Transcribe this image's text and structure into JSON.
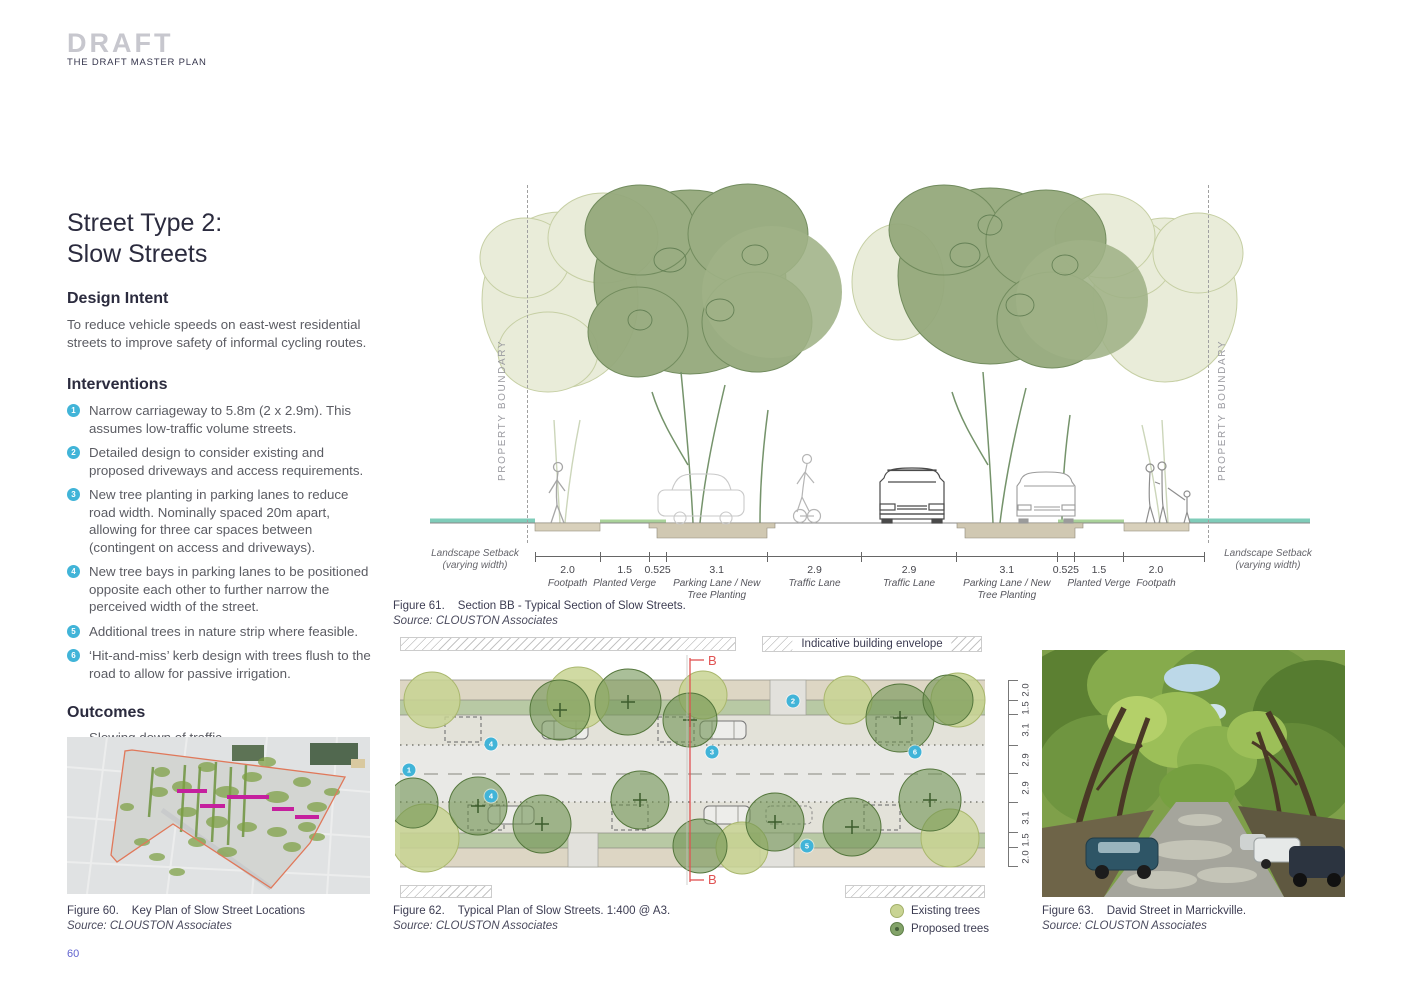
{
  "header": {
    "title": "DRAFT",
    "subtitle": "THE DRAFT MASTER PLAN"
  },
  "page": {
    "number": "60"
  },
  "content": {
    "title_line1": "Street Type 2:",
    "title_line2": "Slow Streets",
    "design_intent": {
      "heading": "Design Intent",
      "body": "To reduce vehicle speeds on east-west residential streets to improve safety of informal cycling routes."
    },
    "interventions": {
      "heading": "Interventions",
      "items": [
        {
          "num": "1",
          "text": "Narrow carriageway to 5.8m (2 x 2.9m). This assumes low-traffic volume streets."
        },
        {
          "num": "2",
          "text": "Detailed design to consider existing and proposed driveways and access requirements."
        },
        {
          "num": "3",
          "text": "New tree planting in parking lanes to reduce road width. Nominally spaced 20m apart, allowing for three car spaces between (contingent on access and driveways)."
        },
        {
          "num": "4",
          "text": "New tree bays in parking lanes to be positioned opposite each other to further narrow the perceived width of the street."
        },
        {
          "num": "5",
          "text": "Additional trees in nature strip where feasible."
        },
        {
          "num": "6",
          "text": "‘Hit-and-miss’ kerb design with trees flush to the road to allow for passive irrigation."
        }
      ]
    },
    "outcomes": {
      "heading": "Outcomes",
      "items": [
        "Slowing down of traffic.",
        "Increase of canopy coverage."
      ]
    }
  },
  "figures": {
    "key_plan": {
      "label": "Figure 60.",
      "title": "Key Plan of Slow Street Locations",
      "source": "Source: CLOUSTON Associates"
    },
    "section": {
      "label": "Figure 61.",
      "title": "Section BB - Typical Section of Slow Streets.",
      "source": "Source:  CLOUSTON Associates",
      "property_boundary": "PROPERTY BOUNDARY",
      "setback_line1": "Landscape Setback",
      "setback_line2": "(varying width)",
      "dimensions": [
        {
          "value": "2.0",
          "label": "Footpath"
        },
        {
          "value": "1.5",
          "label": "Planted Verge"
        },
        {
          "value": "0.525",
          "label": ""
        },
        {
          "value": "3.1",
          "label": "Parking Lane / New Tree Planting"
        },
        {
          "value": "2.9",
          "label": "Traffic Lane"
        },
        {
          "value": "2.9",
          "label": "Traffic Lane"
        },
        {
          "value": "3.1",
          "label": "Parking Lane / New Tree Planting"
        },
        {
          "value": "0.525",
          "label": ""
        },
        {
          "value": "1.5",
          "label": "Planted Verge"
        },
        {
          "value": "2.0",
          "label": "Footpath"
        }
      ]
    },
    "plan": {
      "label": "Figure 62.",
      "title": "Typical Plan of Slow Streets.  1:400 @ A3.",
      "source": "Source: CLOUSTON Associates",
      "building_envelope": "Indicative building envelope",
      "section_marker": "B",
      "cross_dimensions": [
        "2.0",
        "1.5",
        "3.1",
        "2.9",
        "2.9",
        "3.1",
        "1.5",
        "2.0"
      ],
      "markers": [
        {
          "num": "1",
          "x": 409,
          "y": 770
        },
        {
          "num": "2",
          "x": 793,
          "y": 701
        },
        {
          "num": "3",
          "x": 712,
          "y": 752
        },
        {
          "num": "4",
          "x": 491,
          "y": 744
        },
        {
          "num": "4",
          "x": 491,
          "y": 796
        },
        {
          "num": "5",
          "x": 807,
          "y": 846
        },
        {
          "num": "6",
          "x": 915,
          "y": 752
        }
      ],
      "legend": [
        {
          "label": "Existing trees",
          "color": "#c9d493",
          "border": "#a3b06a",
          "dot": ""
        },
        {
          "label": "Proposed trees",
          "color": "#83a369",
          "border": "#5f7f49",
          "dot": "#46603a"
        }
      ]
    },
    "photo": {
      "label": "Figure 63.",
      "title": "David Street in Marrickville.",
      "source": "Source: CLOUSTON Associates"
    }
  },
  "colors": {
    "badge_blue": "#41b4d8",
    "page_number_blue": "#6163cf",
    "section_cut_red": "#e05252",
    "slow_street_magenta": "#c5209e"
  }
}
